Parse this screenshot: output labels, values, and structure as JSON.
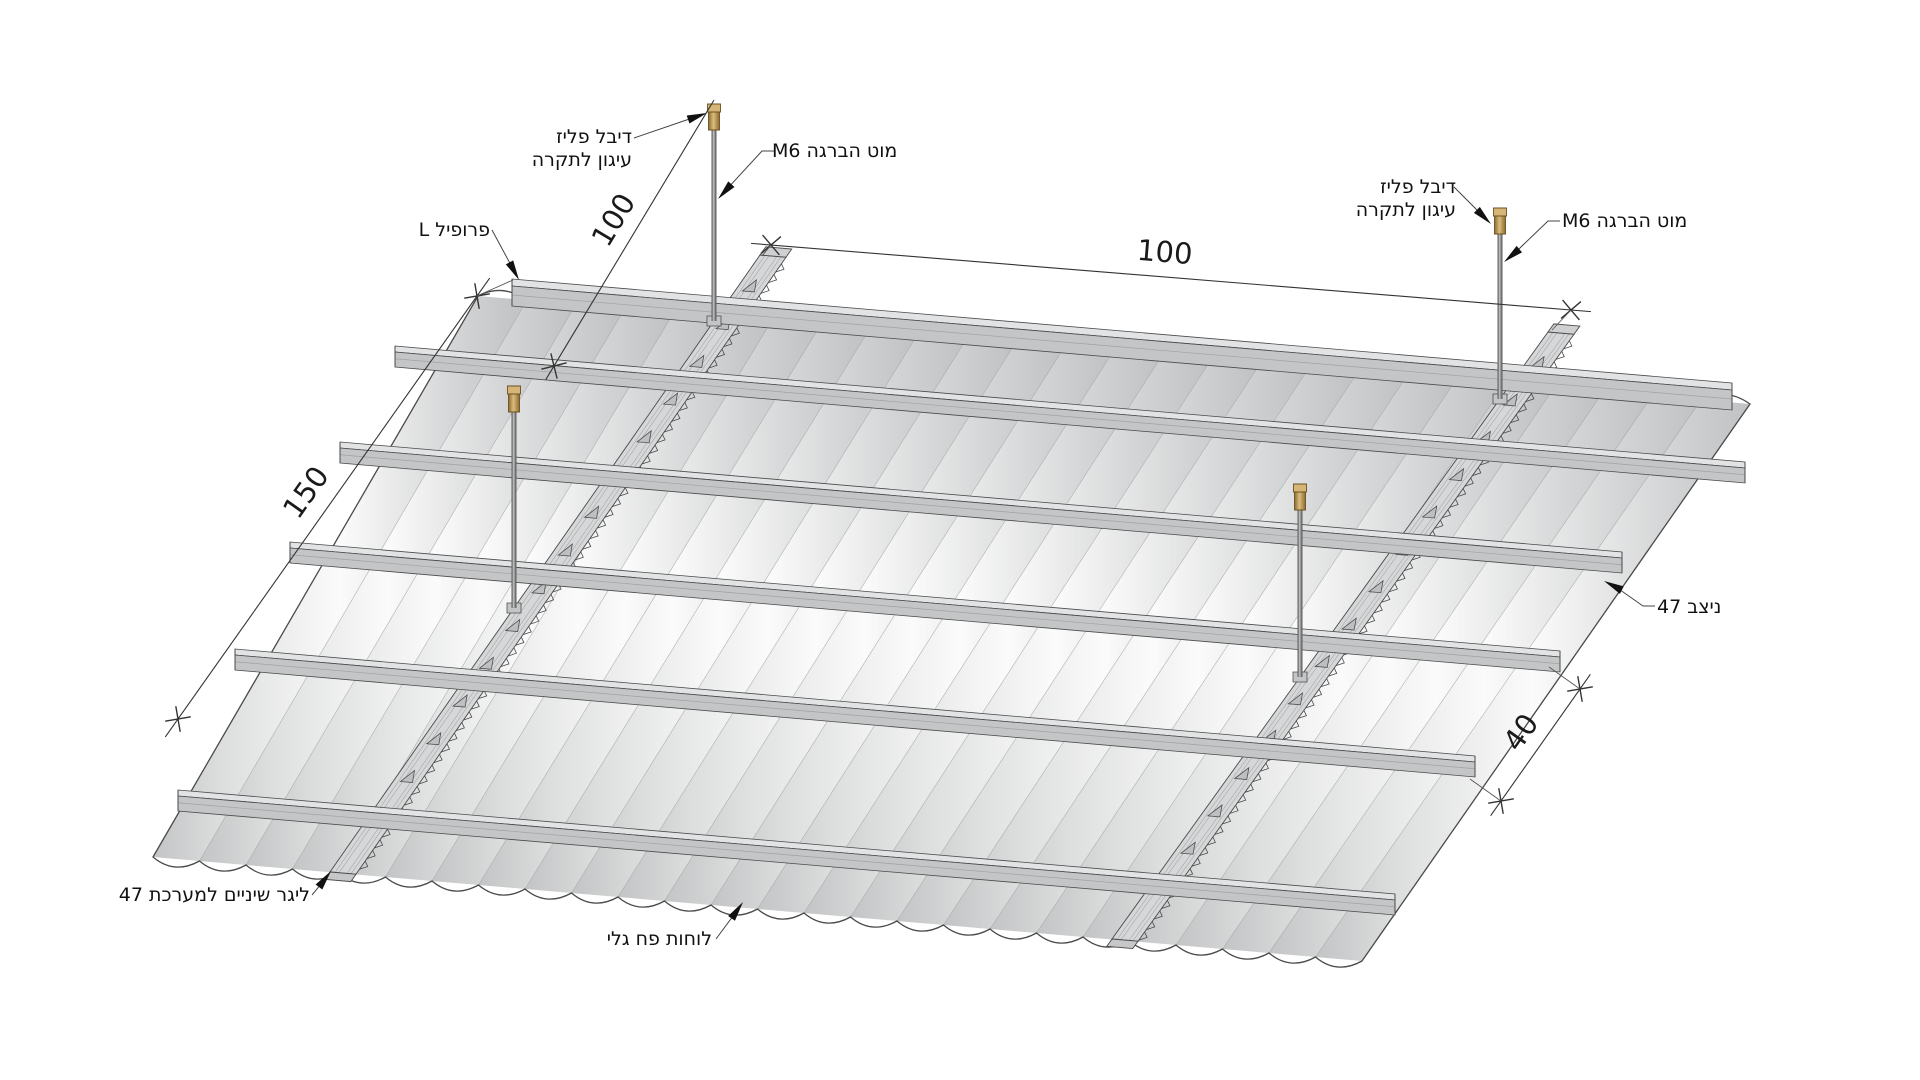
{
  "drawing": {
    "labels": {
      "anchor_left": {
        "line1": "דיבל פליז",
        "line2": "עיגון לתקרה"
      },
      "rod_left": "מוט הברגה M6",
      "l_profile": "פרופיל L",
      "anchor_right": {
        "line1": "דיבל פליז",
        "line2": "עיגון לתקרה"
      },
      "rod_right": "מוט הברגה M6",
      "stud": "ניצב 47",
      "toothed_ligger": "ליגר שיניים למערכת 47",
      "corrugated_sheets": "לוחות פח גלי"
    },
    "dimensions": {
      "hanger_spacing": "150",
      "edge_offset": "100",
      "ligger_spacing": "100",
      "channel_spacing": "40"
    },
    "colors": {
      "background": "#ffffff",
      "metal_face": "#c9cbcc",
      "metal_top": "#e2e3e4",
      "outline": "#4a4a4a",
      "brass": "#c9a45c",
      "rod": "#7a7a7a",
      "text": "#111111",
      "dimension_line": "#333333"
    }
  }
}
